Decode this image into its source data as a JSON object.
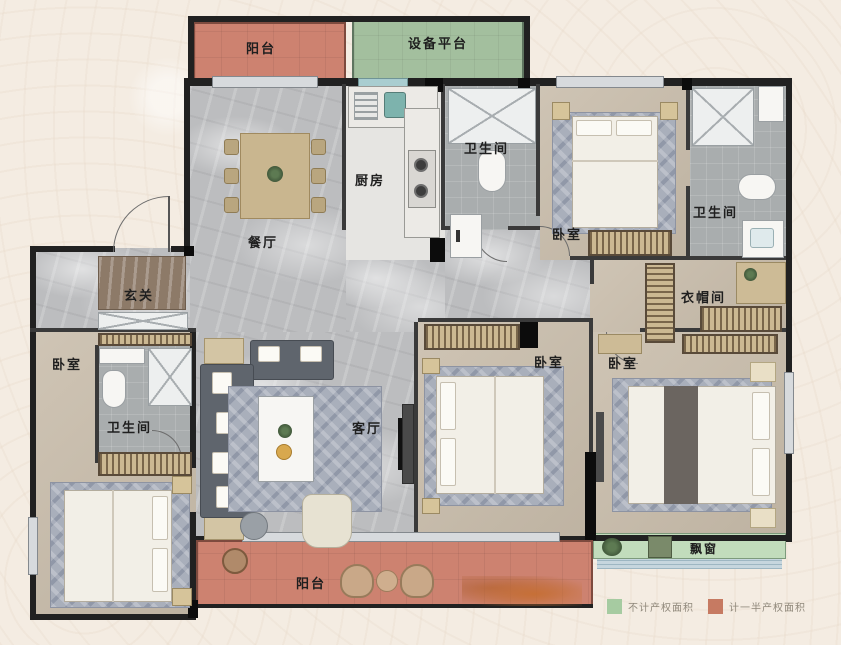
{
  "plan": {
    "title": "四室两厅户型图",
    "rooms": [
      {
        "id": "balcony-top",
        "label": "阳台"
      },
      {
        "id": "equipment-platform",
        "label": "设备平台"
      },
      {
        "id": "kitchen",
        "label": "厨房"
      },
      {
        "id": "bath-middle",
        "label": "卫生间"
      },
      {
        "id": "bedroom-top-right",
        "label": "卧室"
      },
      {
        "id": "bath-top-right",
        "label": "卫生间"
      },
      {
        "id": "dining-room",
        "label": "餐厅"
      },
      {
        "id": "foyer",
        "label": "玄关"
      },
      {
        "id": "cloakroom",
        "label": "衣帽间"
      },
      {
        "id": "bedroom-left",
        "label": "卧室"
      },
      {
        "id": "bath-left",
        "label": "卫生间"
      },
      {
        "id": "living-room",
        "label": "客厅"
      },
      {
        "id": "bedroom-middle",
        "label": "卧室"
      },
      {
        "id": "bedroom-master",
        "label": "卧室"
      },
      {
        "id": "bay-window",
        "label": "飘窗"
      },
      {
        "id": "balcony-bottom",
        "label": "阳台"
      }
    ],
    "legend": [
      {
        "id": "no-property-area",
        "color": "#a6cba1",
        "label": "不计产权面积"
      },
      {
        "id": "half-property-area",
        "color": "#c67a62",
        "label": "计一半产权面积"
      }
    ],
    "colors": {
      "background": "#f4ece2",
      "balcony_fill": "#cd8270",
      "equipment_fill": "#a3bf9e",
      "bay_window_fill": "#c2dcbc",
      "wall": "#212121",
      "floor_marble": "#bcbdbf",
      "floor_bedroom": "#c8bcaa",
      "floor_bath": "#a9adae"
    }
  }
}
